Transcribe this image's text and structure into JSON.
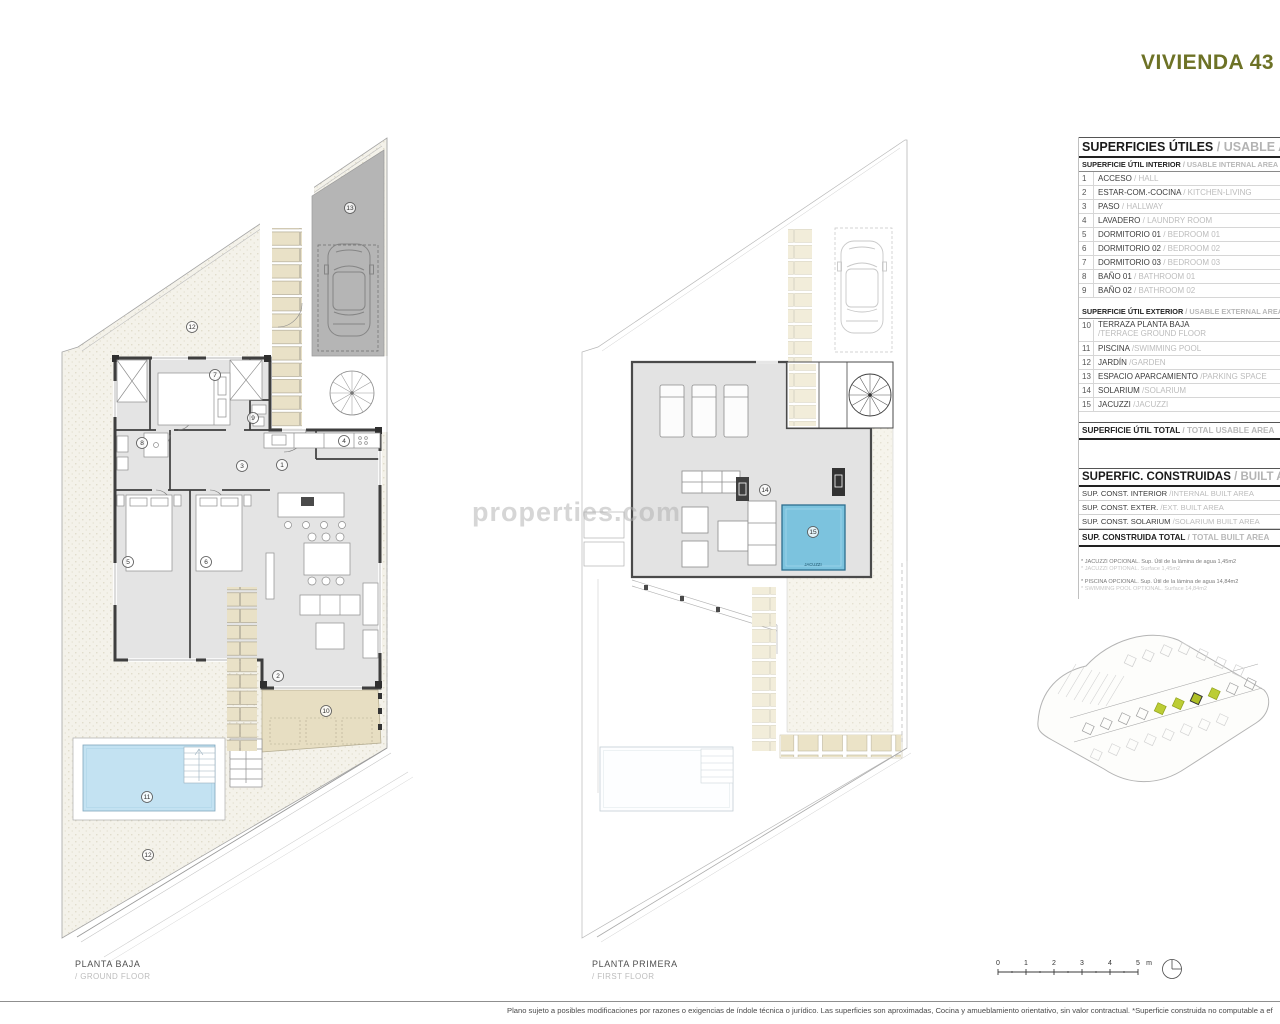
{
  "title": "VIVIENDA 43 TI",
  "watermark": "properties.com",
  "legend": {
    "usable": {
      "title_es": "SUPERFICIES ÚTILES",
      "title_en": "/ USABLE AREA",
      "interior_header_es": "SUPERFICIE ÚTIL INTERIOR",
      "interior_header_en": "/ USABLE INTERNAL AREA",
      "interior_rows": [
        {
          "num": "1",
          "es": "ACCESO",
          "en": "/ HALL"
        },
        {
          "num": "2",
          "es": "ESTAR-COM.-COCINA",
          "en": "/ KITCHEN-LIVING"
        },
        {
          "num": "3",
          "es": "PASO",
          "en": "/ HALLWAY"
        },
        {
          "num": "4",
          "es": "LAVADERO",
          "en": "/ LAUNDRY ROOM"
        },
        {
          "num": "5",
          "es": "DORMITORIO 01",
          "en": "/ BEDROOM 01"
        },
        {
          "num": "6",
          "es": "DORMITORIO 02",
          "en": "/ BEDROOM 02"
        },
        {
          "num": "7",
          "es": "DORMITORIO 03",
          "en": "/ BEDROOM 03"
        },
        {
          "num": "8",
          "es": "BAÑO 01",
          "en": "/ BATHROOM 01"
        },
        {
          "num": "9",
          "es": "BAÑO 02",
          "en": "/ BATHROOM 02"
        }
      ],
      "exterior_header_es": "SUPERFICIE ÚTIL EXTERIOR",
      "exterior_header_en": "/ USABLE EXTERNAL AREA",
      "exterior_rows": [
        {
          "num": "10",
          "es": "TERRAZA PLANTA BAJA",
          "en": "/TERRACE GROUND FLOOR"
        },
        {
          "num": "11",
          "es": "PISCINA",
          "en": "/SWIMMING POOL"
        },
        {
          "num": "12",
          "es": "JARDÍN",
          "en": "/GARDEN"
        },
        {
          "num": "13",
          "es": "ESPACIO APARCAMIENTO",
          "en": "/PARKING SPACE"
        },
        {
          "num": "14",
          "es": "SOLARIUM",
          "en": "/SOLARIUM"
        },
        {
          "num": "15",
          "es": "JACUZZI",
          "en": "/JACUZZI"
        }
      ],
      "total_es": "SUPERFICIE ÚTIL TOTAL",
      "total_en": "/ TOTAL USABLE AREA"
    },
    "built": {
      "title_es": "SUPERFIC. CONSTRUIDAS",
      "title_en": "/ BUILT AREA",
      "rows": [
        {
          "es": "SUP. CONST. INTERIOR",
          "en": "/INTERNAL BUILT AREA"
        },
        {
          "es": "SUP. CONST. EXTER.",
          "en": "/EXT. BUILT AREA"
        },
        {
          "es": "SUP. CONST. SOLARIUM",
          "en": "/SOLARIUM BUILT AREA"
        }
      ],
      "total_es": "SUP. CONSTRUIDA TOTAL",
      "total_en": "/ TOTAL BUILT AREA"
    },
    "notes": [
      {
        "es": "* JACUZZI OPCIONAL. Sup. Útil de la lámina de agua 1,45m2",
        "en": "* JACUZZI OPTIONAL. Surface 1,45m2"
      },
      {
        "es": "* PISCINA OPCIONAL. Sup. Útil de la lámina de agua 14,84m2",
        "en": "* SWIMMING POOL OPTIONAL. Surface 14,84m2"
      }
    ]
  },
  "plans": {
    "ground": {
      "label_es": "PLANTA BAJA",
      "label_en": "/ GROUND FLOOR"
    },
    "first": {
      "label_es": "PLANTA PRIMERA",
      "label_en": "/ FIRST FLOOR"
    }
  },
  "markers": {
    "n1": "1",
    "n2": "2",
    "n3": "3",
    "n4": "4",
    "n5": "5",
    "n6": "6",
    "n7": "7",
    "n8": "8",
    "n9": "9",
    "n10": "10",
    "n11": "11",
    "n12": "12",
    "n13": "13",
    "n14": "14",
    "n15": "15",
    "jacuzzi": "JACUZZI"
  },
  "scalebar": {
    "ticks": [
      "0",
      "1",
      "2",
      "3",
      "4",
      "5"
    ],
    "unit": "m"
  },
  "footer": "Plano sujeto a posibles modificaciones por razones o exigencias de índole técnica o jurídico. Las superficies son aproximadas, Cocina y amueblamiento orientativo, sin valor contractual. *Superficie construida no computable a ef"
}
